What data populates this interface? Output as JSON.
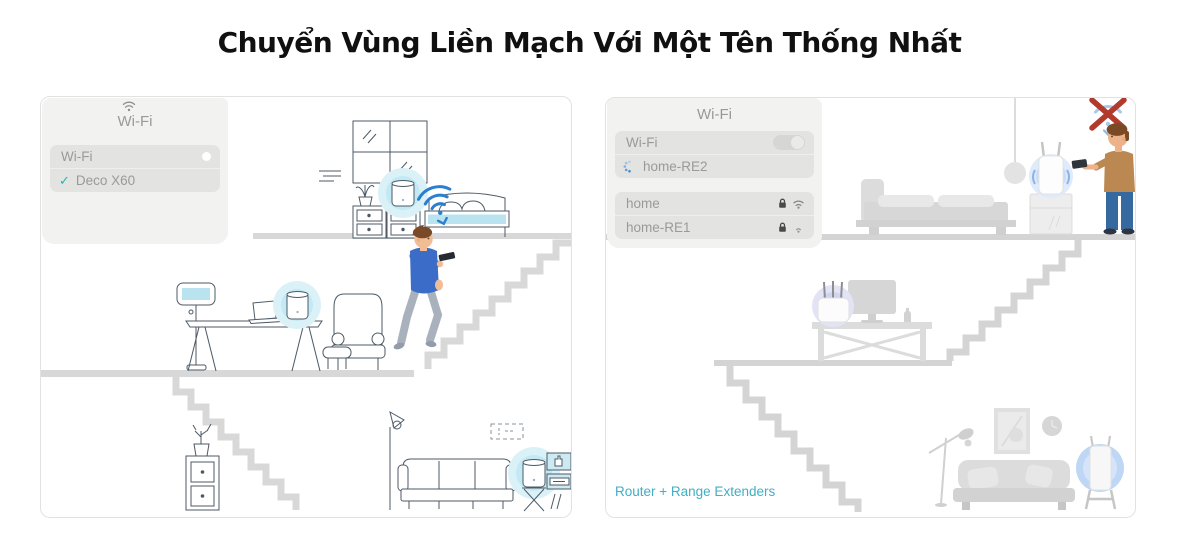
{
  "title": "Chuyển Vùng Liền Mạch Với Một Tên Thống Nhất",
  "left_panel": {
    "popup": {
      "title": "Wi-Fi",
      "wifi_toggle_label": "Wi-Fi",
      "check_glyph": "✓",
      "network_name": "Deco X60"
    }
  },
  "right_panel": {
    "popup": {
      "title": "Wi-Fi",
      "wifi_toggle_label": "Wi-Fi",
      "connecting_network": "home-RE2",
      "networks": [
        {
          "name": "home",
          "locked": true,
          "signal": "strong"
        },
        {
          "name": "home-RE1",
          "locked": true,
          "signal": "weak"
        }
      ]
    },
    "caption": "Router + Range Extenders"
  },
  "icons": {
    "left_popup_header": "wifi-icon",
    "left_selected_mark": "check-icon",
    "toggle": "toggle-switch",
    "connecting": "spinner-icon",
    "network_security": "lock-icon",
    "network_signal": "wifi-icon",
    "blocked_signal": "no-wifi-icon"
  },
  "colors": {
    "title_text": "#101010",
    "popup_bg": "#f2f2f1",
    "popup_row_bg": "#e3e3e2",
    "popup_text": "#9a9a98",
    "check_teal": "#23b5ae",
    "glow_blue": "#c2e9f4",
    "accent_blue_fill": "#b9e4ef",
    "wifi_signal_blue": "#2b7fd0",
    "line_art": "#4d5a66",
    "furniture_gray": "#dcdcdc",
    "caption_teal": "#3fafc4",
    "error_red": "#b23a2c",
    "shirt_blue": "#3a6cc8",
    "shirt_tan": "#bb8851"
  }
}
